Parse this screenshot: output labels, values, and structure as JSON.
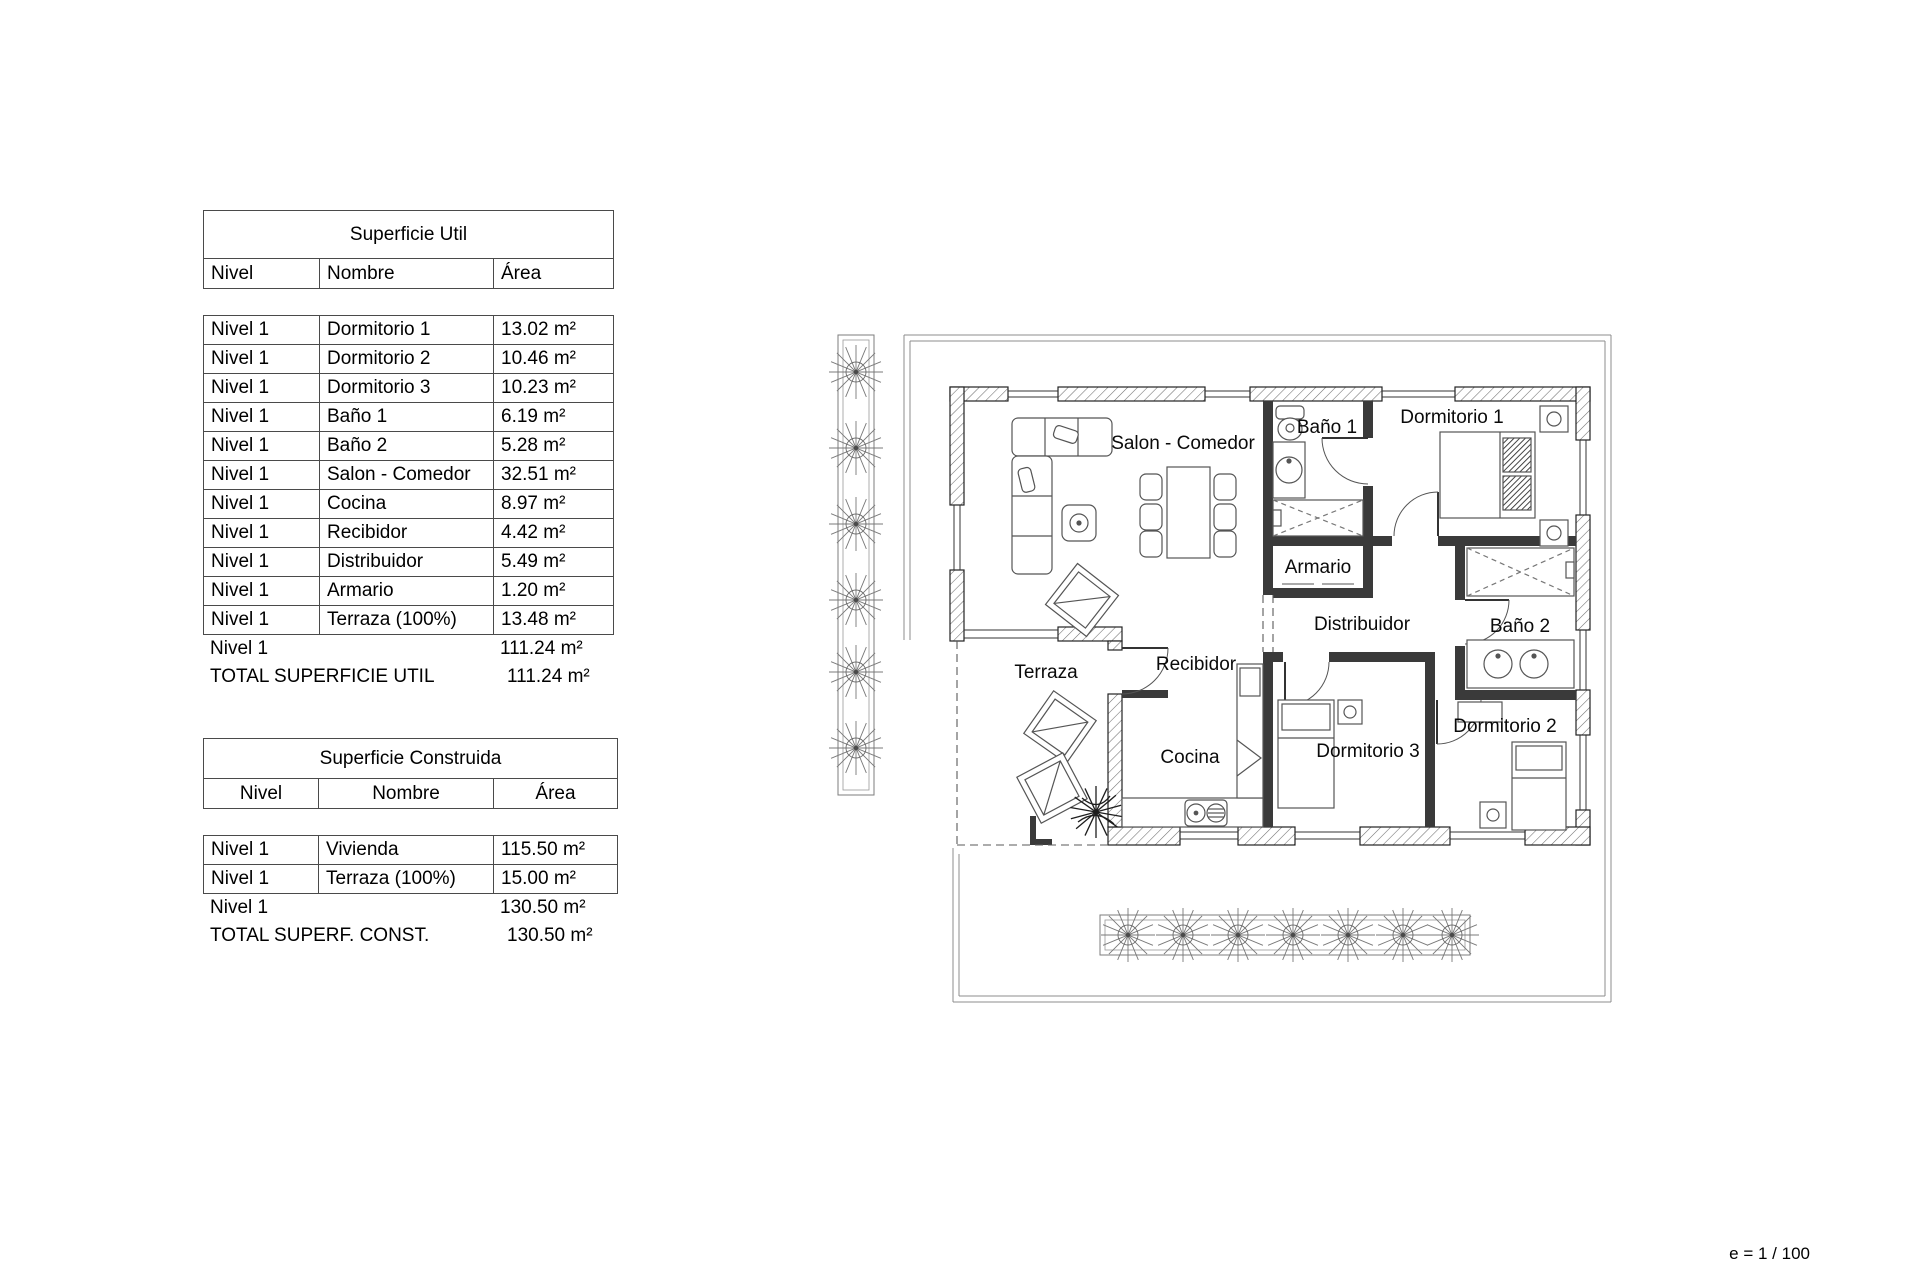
{
  "scale_note": "e = 1 / 100",
  "tables": {
    "superficie_util": {
      "title": "Superficie Util",
      "columns": [
        "Nivel",
        "Nombre",
        "Área"
      ],
      "rows": [
        {
          "nivel": "Nivel 1",
          "nombre": "Dormitorio 1",
          "area": "13.02 m²"
        },
        {
          "nivel": "Nivel 1",
          "nombre": "Dormitorio 2",
          "area": "10.46 m²"
        },
        {
          "nivel": "Nivel 1",
          "nombre": "Dormitorio 3",
          "area": "10.23 m²"
        },
        {
          "nivel": "Nivel 1",
          "nombre": "Baño 1",
          "area": "6.19 m²"
        },
        {
          "nivel": "Nivel 1",
          "nombre": "Baño 2",
          "area": "5.28 m²"
        },
        {
          "nivel": "Nivel 1",
          "nombre": "Salon - Comedor",
          "area": "32.51 m²"
        },
        {
          "nivel": "Nivel 1",
          "nombre": "Cocina",
          "area": "8.97 m²"
        },
        {
          "nivel": "Nivel 1",
          "nombre": "Recibidor",
          "area": "4.42 m²"
        },
        {
          "nivel": "Nivel 1",
          "nombre": "Distribuidor",
          "area": "5.49 m²"
        },
        {
          "nivel": "Nivel 1",
          "nombre": "Armario",
          "area": "1.20 m²"
        },
        {
          "nivel": "Nivel 1",
          "nombre": "Terraza (100%)",
          "area": "13.48 m²"
        }
      ],
      "subtotal": {
        "nivel": "Nivel 1",
        "area": "111.24 m²"
      },
      "total": {
        "label": "TOTAL SUPERFICIE UTIL",
        "area": "111.24 m²"
      }
    },
    "superficie_construida": {
      "title": "Superficie Construida",
      "columns": [
        "Nivel",
        "Nombre",
        "Área"
      ],
      "rows": [
        {
          "nivel": "Nivel 1",
          "nombre": "Vivienda",
          "area": "115.50 m²"
        },
        {
          "nivel": "Nivel 1",
          "nombre": "Terraza (100%)",
          "area": "15.00 m²"
        }
      ],
      "subtotal": {
        "nivel": "Nivel 1",
        "area": "130.50 m²"
      },
      "total": {
        "label": "TOTAL SUPERF. CONST.",
        "area": "130.50 m²"
      }
    }
  },
  "floor_plan": {
    "rooms": {
      "salon_comedor": "Salon - Comedor",
      "bano_1": "Baño 1",
      "dormitorio_1": "Dormitorio 1",
      "armario": "Armario",
      "distribuidor": "Distribuidor",
      "bano_2": "Baño 2",
      "terraza": "Terraza",
      "recibidor": "Recibidor",
      "cocina": "Cocina",
      "dormitorio_3": "Dormitorio 3",
      "dormitorio_2": "Dormitorio 2"
    }
  }
}
